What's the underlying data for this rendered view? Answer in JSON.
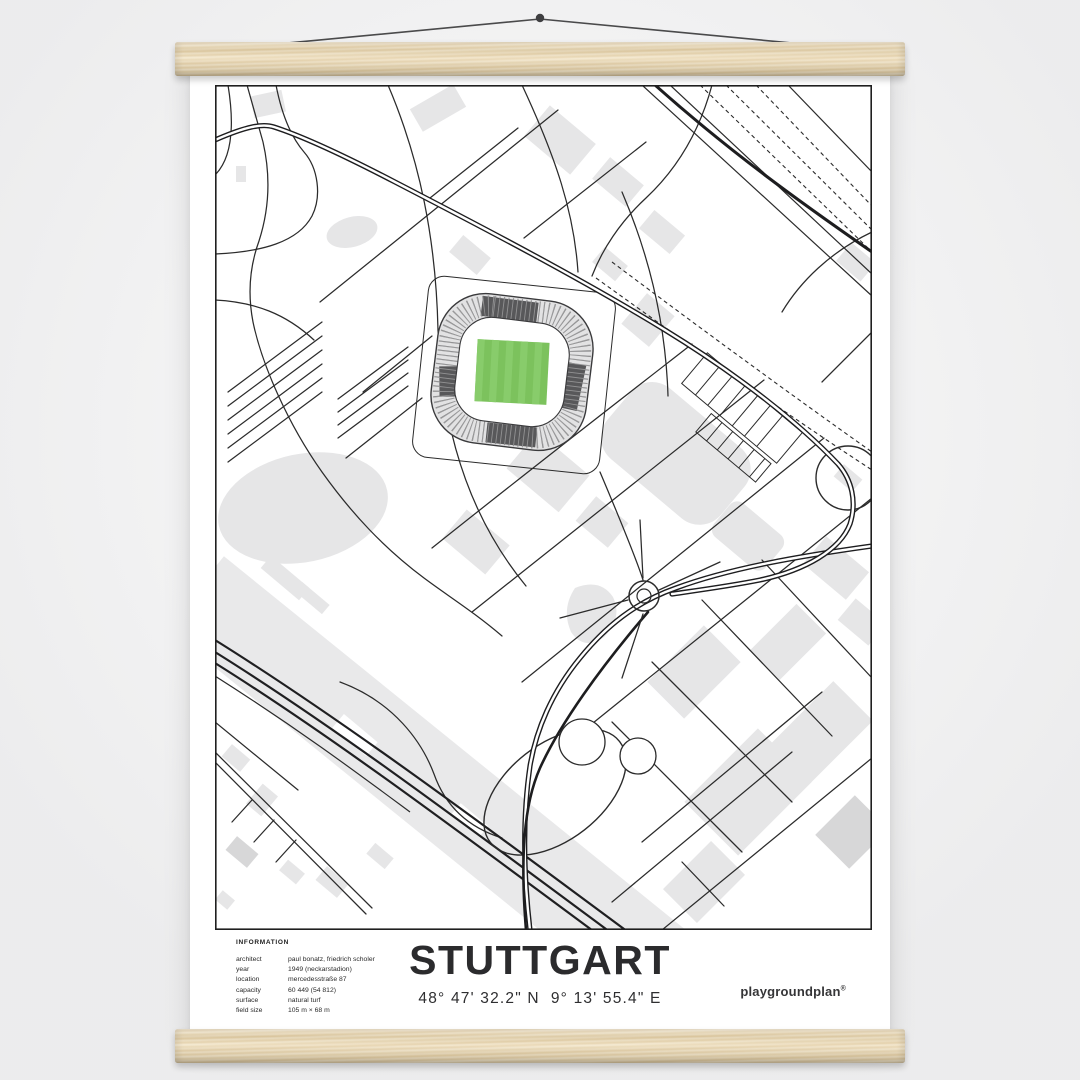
{
  "poster": {
    "title": "STUTTGART",
    "coordinates": "48° 47' 32.2\" N  9° 13' 55.4\" E",
    "brand_name": "playgroundplan",
    "brand_mark": "®",
    "info": {
      "heading": "INFORMATION",
      "rows": [
        {
          "label": "architect",
          "value": "paul bonatz, friedrich scholer"
        },
        {
          "label": "year",
          "value": "1949 (neckarstadion)"
        },
        {
          "label": "location",
          "value": "mercedesstraße 87"
        },
        {
          "label": "capacity",
          "value": "60 449 (54 812)"
        },
        {
          "label": "surface",
          "value": "natural turf"
        },
        {
          "label": "field size",
          "value": "105 m × 68 m"
        }
      ]
    }
  },
  "colors": {
    "background": "#f4f4f5",
    "poster": "#ffffff",
    "wood": "#ecd9b6",
    "string": "#4a4a4b",
    "map_line": "#2b2b2b",
    "building": "#e6e6e7",
    "building_dark": "#d7d7d8",
    "band": "#e9e9ea",
    "stand_gray": "#e2e2e3",
    "stand_dark": "#58585a",
    "pitch_green": "#7cc25d",
    "pitch_green_light": "#88cc6b"
  }
}
